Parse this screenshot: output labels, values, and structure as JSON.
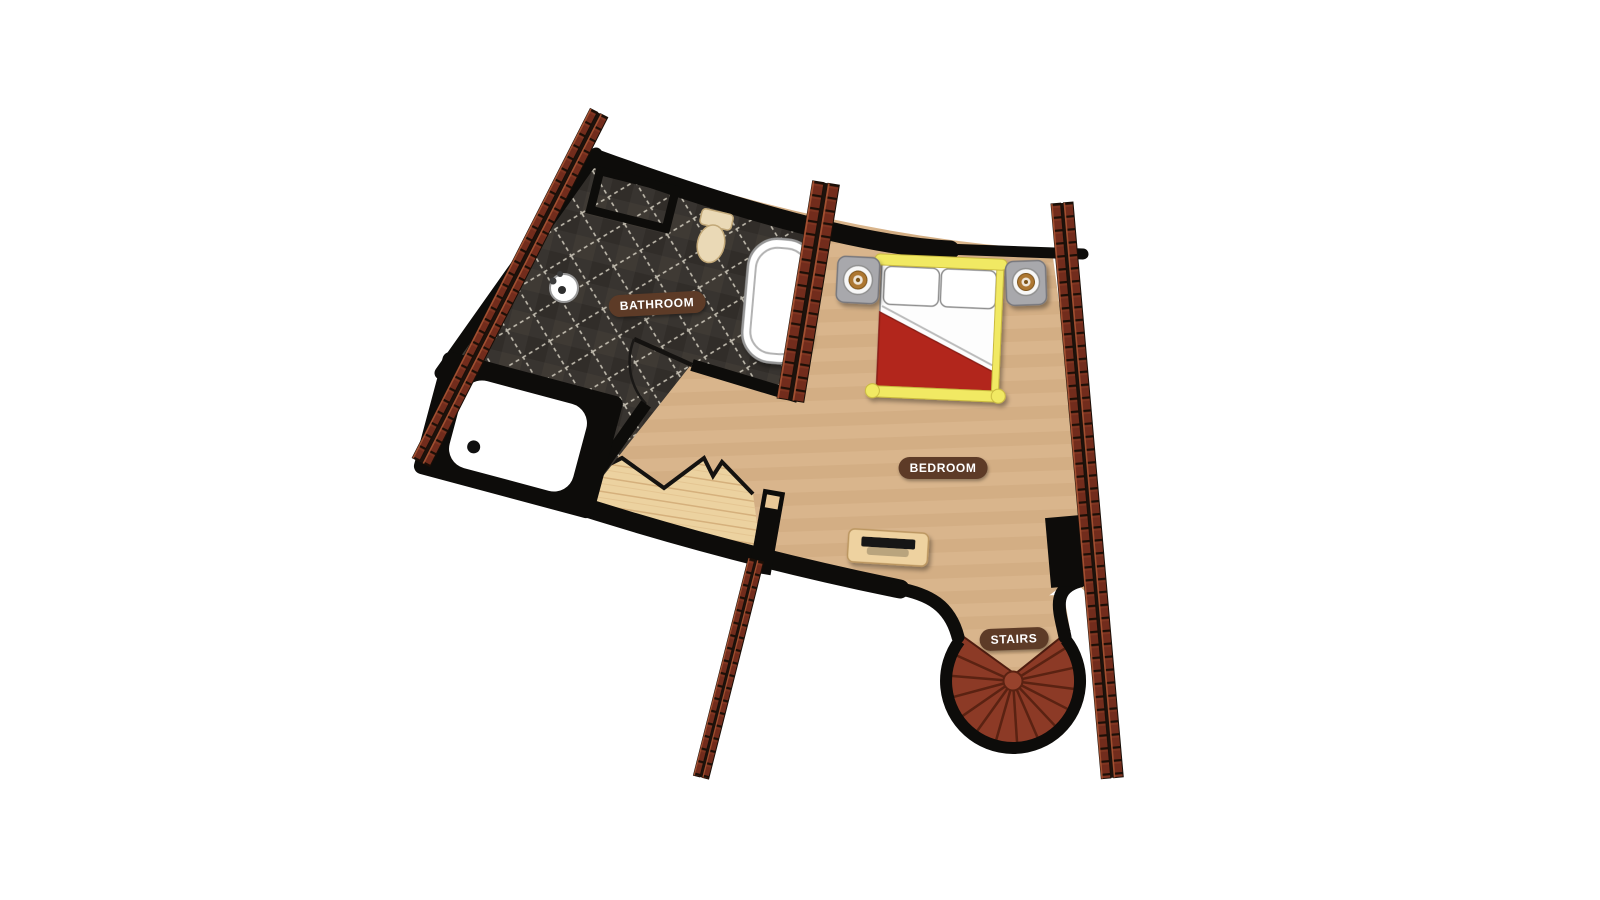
{
  "floorplan": {
    "rooms": {
      "bathroom": {
        "label": "BATHROOM"
      },
      "bedroom": {
        "label": "BEDROOM"
      },
      "stairs": {
        "label": "STAIRS"
      }
    },
    "fixtures": [
      "shower-tray",
      "bathtub",
      "toilet",
      "sink",
      "double-bed",
      "nightstand-left",
      "nightstand-right",
      "bench",
      "newel-post",
      "spiral-staircase",
      "timber-beam-left",
      "timber-beam-middle",
      "timber-beam-right",
      "timber-beam-bottom"
    ],
    "colors": {
      "background": "#ffffff",
      "wall": "#0d0c0a",
      "bedroom_floor": "#d9b58c",
      "bathroom_floor": "#383430",
      "wood_floor": "#ecd2a0",
      "brick_beam": "#722c1c",
      "brick_highlight": "#a85434",
      "stairs_fill": "#8c3a26",
      "bed_blanket": "#b2271a",
      "bed_frame": "#f1e964",
      "nightstand": "#a8a8ac",
      "label_background": "#5d3b27",
      "label_text": "#ffffff"
    }
  }
}
